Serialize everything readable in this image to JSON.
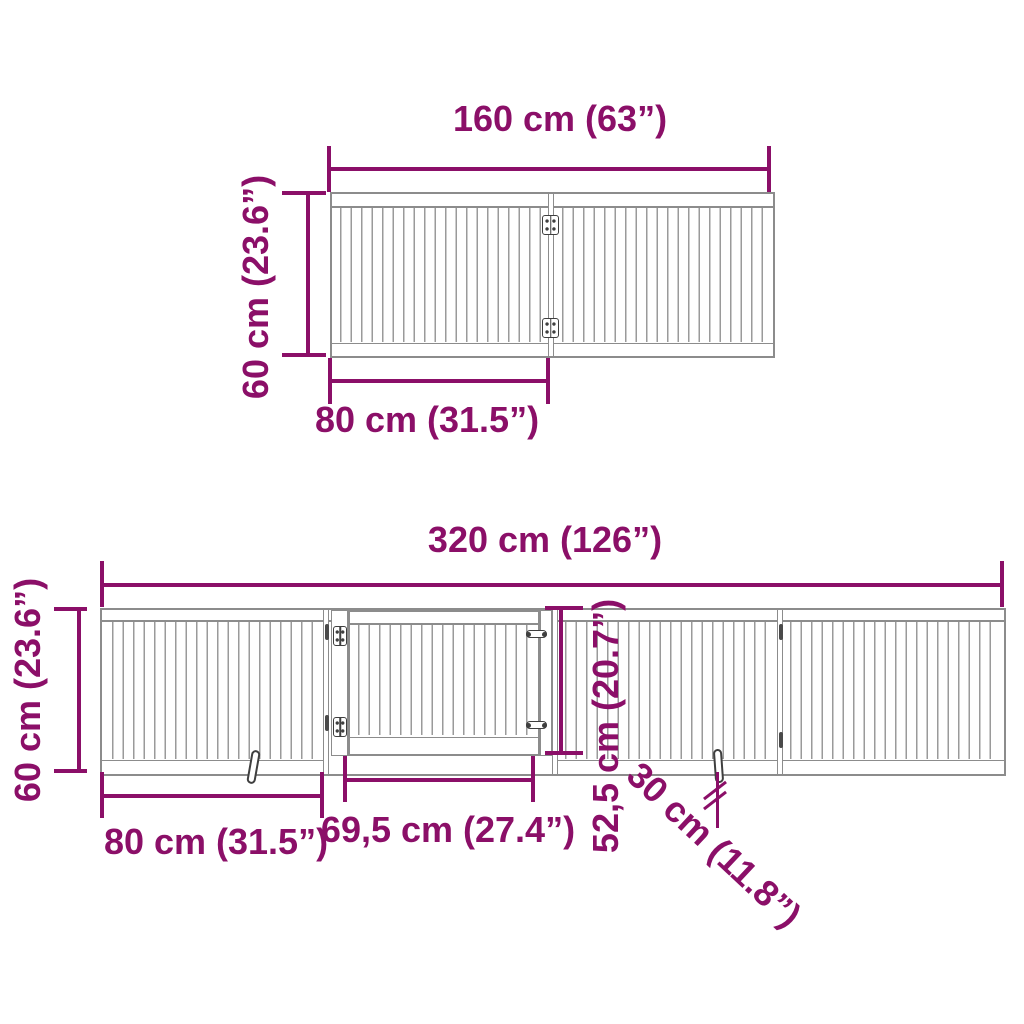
{
  "colors": {
    "dimension": "#8B0F68",
    "outline": "#8C8C8C",
    "slat": "#9A9A9A",
    "hardware": "#3F3F3F"
  },
  "top_view": {
    "panels": 2,
    "width_label": "160 cm (63”)",
    "height_label": "60 cm (23.6”)",
    "panel_width_label": "80 cm (31.5”)"
  },
  "bottom_view": {
    "panels": 4,
    "has_door": true,
    "width_label": "320 cm (126”)",
    "height_label": "60 cm (23.6”)",
    "panel_width_label": "80 cm (31.5”)",
    "door_width_label": "69,5 cm (27.4”)",
    "door_height_label": "52,5 cm (20.7”)",
    "foot_length_label": "30 cm (11.8”)"
  }
}
